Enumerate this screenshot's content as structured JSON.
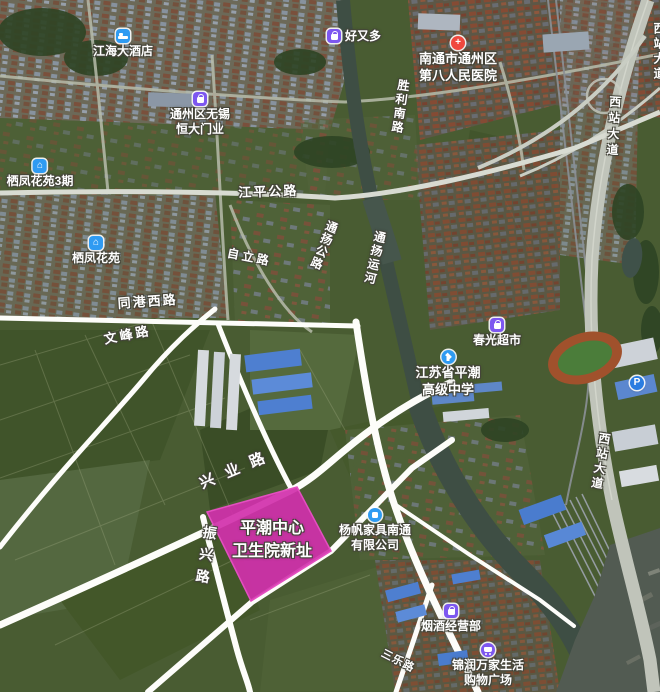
{
  "highlight": {
    "line1": "平潮中心",
    "line2": "卫生院新址",
    "fill_color": "#d130ab"
  },
  "pois": [
    {
      "label": "江海大酒店",
      "icon": "hotel-bed-icon"
    },
    {
      "label": "好又多",
      "icon": "shopping-bag-icon"
    },
    {
      "label": "南通市通州区",
      "label2": "第八人民医院",
      "icon": "hospital-cross-icon"
    },
    {
      "label": "通州区无锡",
      "label2": "恒大门业",
      "icon": "shopping-bag-icon"
    },
    {
      "label": "栖凤花苑3期",
      "icon": "residence-icon"
    },
    {
      "label": "栖凤花苑",
      "icon": "residence-icon"
    },
    {
      "label": "春光超市",
      "icon": "shopping-bag-icon"
    },
    {
      "label": "江苏省平潮",
      "label2": "高级中学",
      "icon": "school-cap-icon"
    },
    {
      "label": "杨帆家具南通",
      "label2": "有限公司",
      "icon": "company-icon"
    },
    {
      "label": "烟酒经营部",
      "icon": "shopping-bag-icon"
    },
    {
      "label": "锦润万家生活",
      "label2": "购物广场",
      "icon": "cart-icon"
    },
    {
      "label": "P",
      "icon": "parking-icon"
    }
  ],
  "icons": {
    "residence_glyph": "⌂",
    "hospital_glyph": "+"
  },
  "road_labels": [
    {
      "text": "江平公路"
    },
    {
      "text": "胜利南路"
    },
    {
      "text": "通扬公路"
    },
    {
      "text": "通扬运河"
    },
    {
      "text": "同港西路"
    },
    {
      "text": "文峰路"
    },
    {
      "text": "自立路"
    },
    {
      "text": "西站大道"
    },
    {
      "text": "西站大道"
    },
    {
      "text": "西站大道"
    },
    {
      "text": "兴业路"
    },
    {
      "text": "振兴路"
    },
    {
      "text": "三乐路"
    }
  ],
  "colors": {
    "highlight_fill": "#d130ab",
    "highlight_stroke": "#e44fc0",
    "drawn_road": "#fdfdfa",
    "water": "#3e4e44",
    "poi_purple": "#7d57f0",
    "poi_blue": "#2f9bf2",
    "poi_red": "#f0483e"
  }
}
